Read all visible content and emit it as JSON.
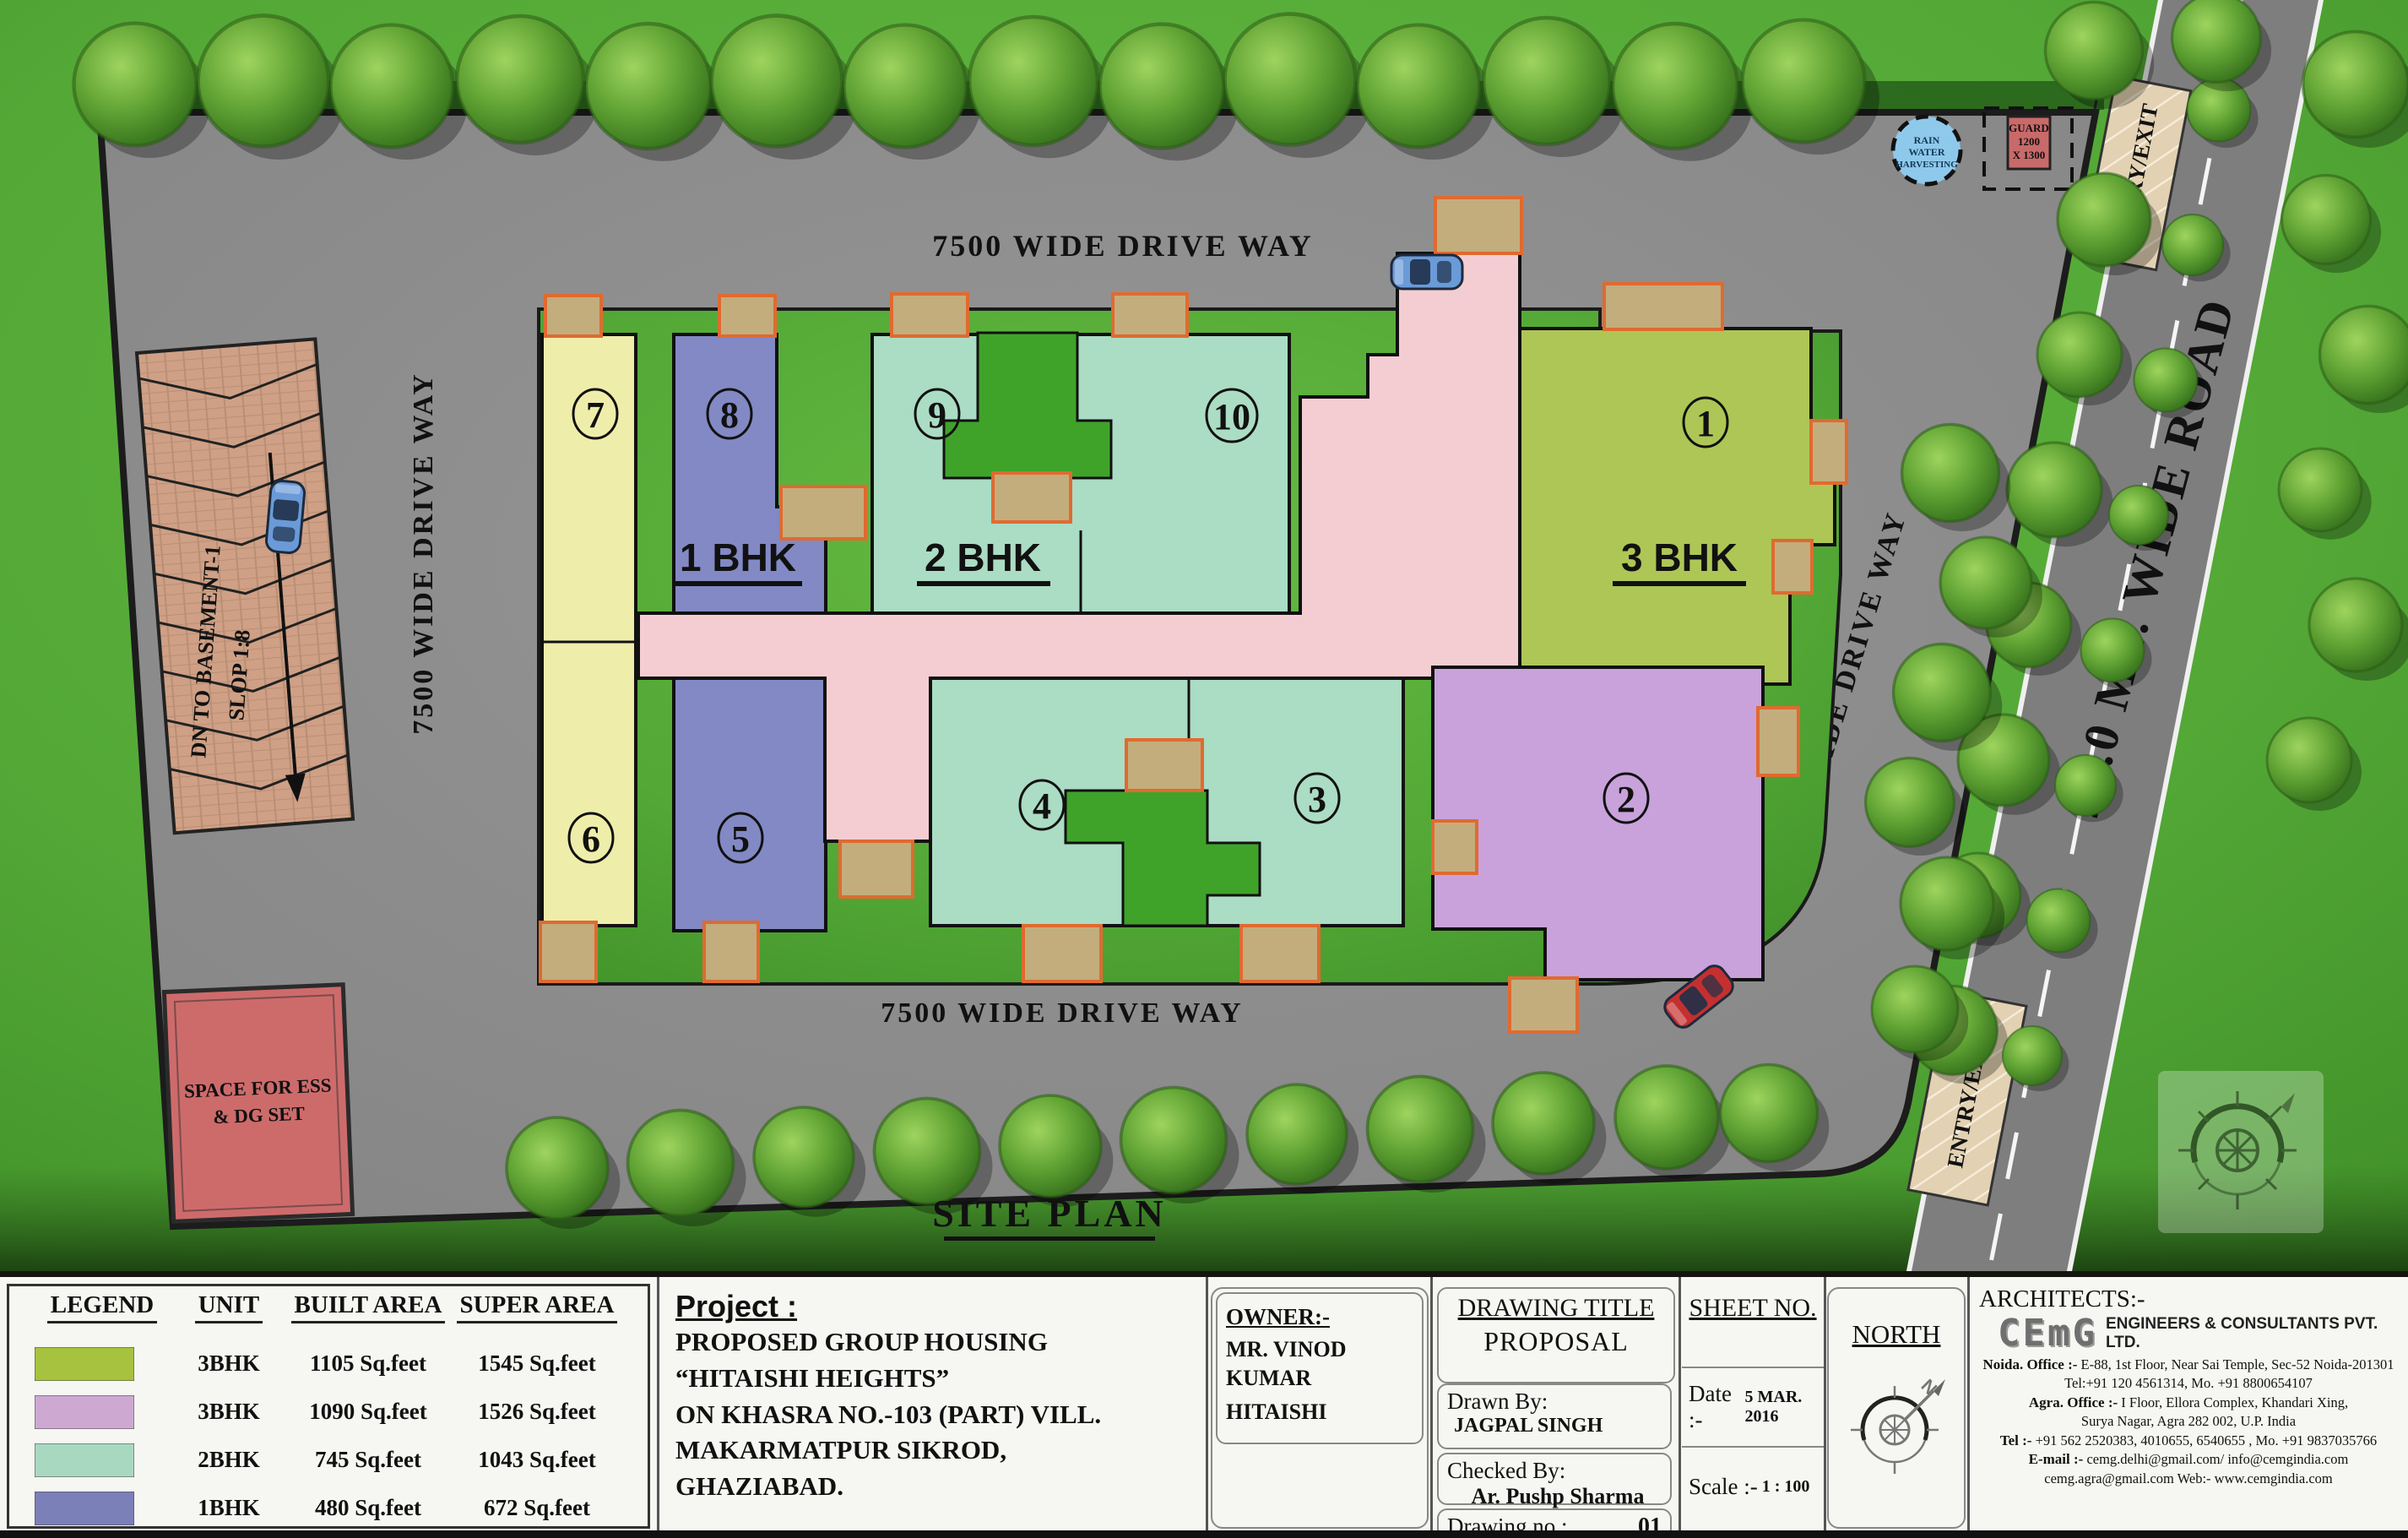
{
  "palette": {
    "olive": "#aec656",
    "salmon": "#f4cdd2",
    "teal": "#abdcc4",
    "periwinkle": "#8289c4",
    "cream": "#efedaa",
    "lavender": "#c9a2dc",
    "balcony": "#c3ad7d",
    "balcony_border": "#e06a30",
    "lawn": "#3fa32a",
    "asphalt": "#8d8d8d",
    "road": "#7e7e7e",
    "ramp": "#cfa086",
    "ess_red": "#cd6b6b",
    "guard_red": "#c96a6a",
    "rain_blue": "#8ec9ec"
  },
  "site_plan": {
    "title": "SITE PLAN",
    "driveway_top": "7500 WIDE DRIVE WAY",
    "driveway_left": "7500 WIDE DRIVE WAY",
    "driveway_right": "7500 WIDE DRIVE WAY",
    "driveway_bottom": "7500 WIDE DRIVE WAY",
    "road": "24.0 MT. WIDE ROAD",
    "entry_exit_top": "ENTRY/EXIT",
    "entry_exit_bottom": "ENTRY/EXIT",
    "ramp": {
      "line1": "DN TO BASEMENT-1",
      "line2": "SLOP 1:8"
    },
    "ess": {
      "line1": "SPACE FOR ESS",
      "line2": "& DG SET"
    },
    "guard": {
      "line1": "GUARD",
      "line2": "1200",
      "line3": "X 1300"
    },
    "rain": {
      "line1": "RAIN",
      "line2": "WATER",
      "line3": "HARVESTING"
    },
    "bhk": {
      "one": "1 BHK",
      "two": "2 BHK",
      "three": "3 BHK"
    },
    "buildings": [
      {
        "no": "1"
      },
      {
        "no": "2"
      },
      {
        "no": "3"
      },
      {
        "no": "4"
      },
      {
        "no": "5"
      },
      {
        "no": "6"
      },
      {
        "no": "7"
      },
      {
        "no": "8"
      },
      {
        "no": "9"
      },
      {
        "no": "10"
      }
    ]
  },
  "legend": {
    "headers": [
      "LEGEND",
      "UNIT",
      "BUILT AREA",
      "SUPER AREA"
    ],
    "rows": [
      {
        "color": "#a6c23e",
        "unit": "3BHK",
        "built": "1105 Sq.feet",
        "super": "1545 Sq.feet"
      },
      {
        "color": "#cda9d2",
        "unit": "3BHK",
        "built": "1090 Sq.feet",
        "super": "1526 Sq.feet"
      },
      {
        "color": "#a9d8c0",
        "unit": "2BHK",
        "built": "745 Sq.feet",
        "super": "1043 Sq.feet"
      },
      {
        "color": "#7b80b8",
        "unit": "1BHK",
        "built": "480 Sq.feet",
        "super": "672 Sq.feet"
      },
      {
        "color": "#e9e9a6",
        "unit": "1BHK",
        "built": "420 Sq.feet",
        "super": "588 Sq.feet"
      }
    ]
  },
  "project": {
    "label": "Project :",
    "lines": [
      "PROPOSED GROUP HOUSING",
      "“HITAISHI HEIGHTS”",
      "ON KHASRA NO.-103 (PART) VILL.",
      "MAKARMATPUR SIKROD,",
      "GHAZIABAD."
    ]
  },
  "owner": {
    "label": "OWNER:-",
    "line1": "MR. VINOD KUMAR",
    "line2": "HITAISHI"
  },
  "drawing": {
    "title_label": "DRAWING TITLE",
    "title": "PROPOSAL",
    "drawn_label": "Drawn By:",
    "drawn": "JAGPAL SINGH",
    "checked_label": "Checked By:",
    "checked": "Ar. Pushp Sharma",
    "no_label": "Drawing no :",
    "no": "01"
  },
  "sheet": {
    "label": "SHEET NO.",
    "date_label": "Date :-",
    "date": "5 MAR. 2016",
    "scale_label": "Scale :-",
    "scale": "1 : 100"
  },
  "north": {
    "label": "NORTH",
    "n": "N"
  },
  "architects": {
    "label": "ARCHITECTS:-",
    "logo": "CEmG",
    "company": "ENGINEERS & CONSULTANTS PVT. LTD.",
    "address": [
      {
        "label": "Noida. Office :-",
        "text": "E-88, 1st Floor, Near Sai Temple, Sec-52 Noida-201301"
      },
      {
        "label": "",
        "text": "Tel:+91 120 4561314, Mo. +91 8800654107"
      },
      {
        "label": "Agra. Office :-",
        "text": "I Floor, Ellora Complex, Khandari Xing,"
      },
      {
        "label": "",
        "text": "Surya Nagar, Agra 282 002, U.P. India"
      },
      {
        "label": "Tel :-",
        "text": "+91 562 2520383, 4010655, 6540655 , Mo. +91 9837035766"
      },
      {
        "label": "E-mail :-",
        "text": "cemg.delhi@gmail.com/ info@cemgindia.com"
      },
      {
        "label": "",
        "text": "cemg.agra@gmail.com  Web:- www.cemgindia.com"
      }
    ]
  }
}
